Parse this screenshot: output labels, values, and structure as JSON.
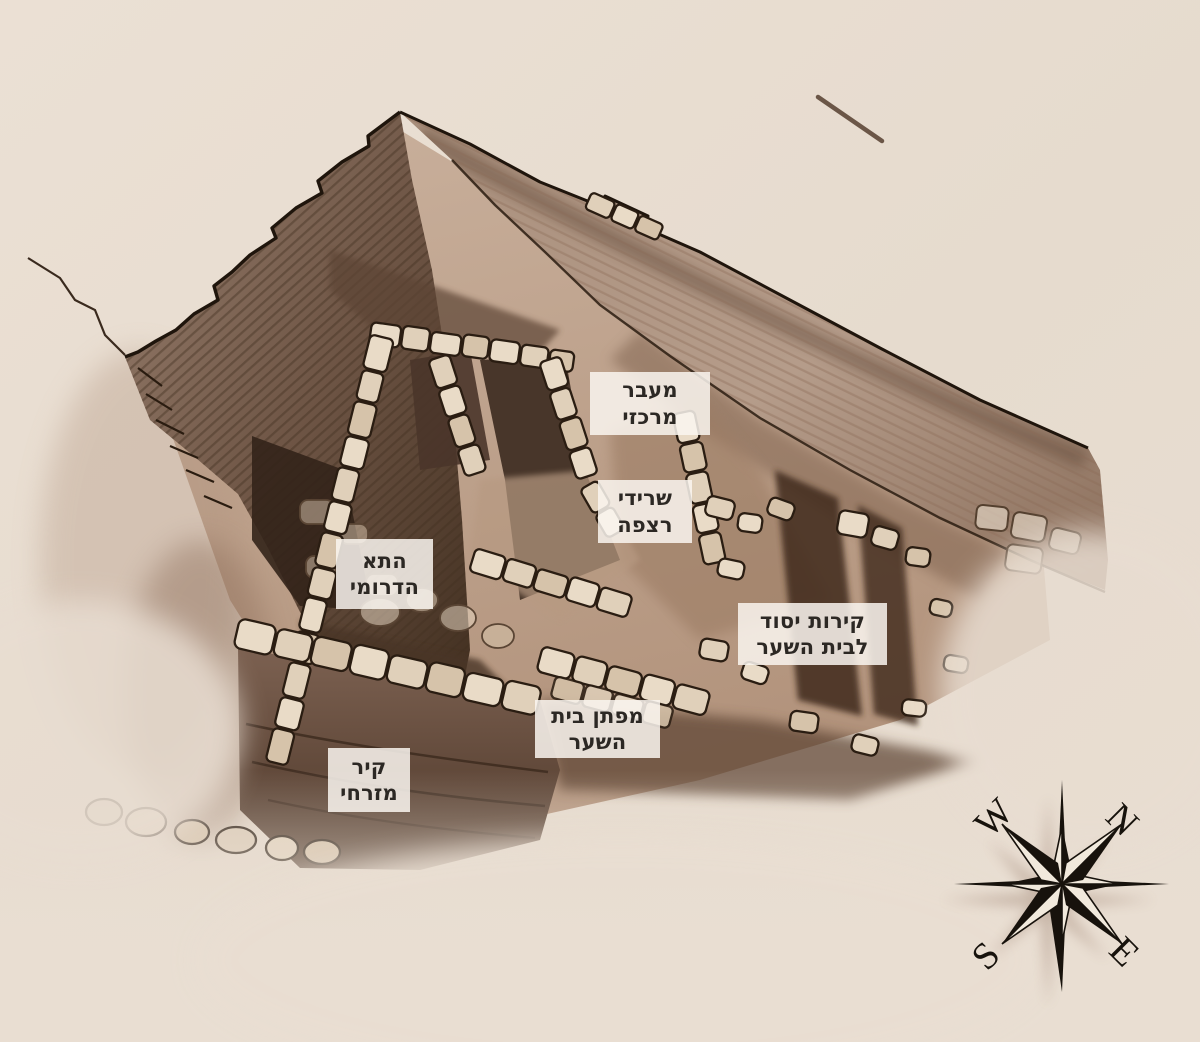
{
  "labels": {
    "central_passage": {
      "line1": "מעבר",
      "line2": "מרכזי"
    },
    "floor_remains": {
      "line1": "שרידי",
      "line2": "רצפה"
    },
    "southern_chamber": {
      "line1": "התא",
      "line2": "הדרומי"
    },
    "foundation_walls": {
      "line1": "קירות יסוד",
      "line2": "לבית השער"
    },
    "gate_threshold": {
      "line1": "מפתן בית",
      "line2": "השער"
    },
    "eastern_wall": {
      "line1": "קיר",
      "line2": "מזרחי"
    }
  },
  "compass": {
    "west": "W",
    "north": "N",
    "south": "S",
    "east": "E"
  },
  "colors": {
    "background": "#e7dcd0",
    "ink": "#261a10",
    "stone_fill": "#e9dbc7",
    "wall_dark": "#43301f",
    "wall_light": "#b79e8c",
    "label_background": "#faf6f0",
    "label_text": "#2c2824",
    "compass_black": "#17120c"
  }
}
